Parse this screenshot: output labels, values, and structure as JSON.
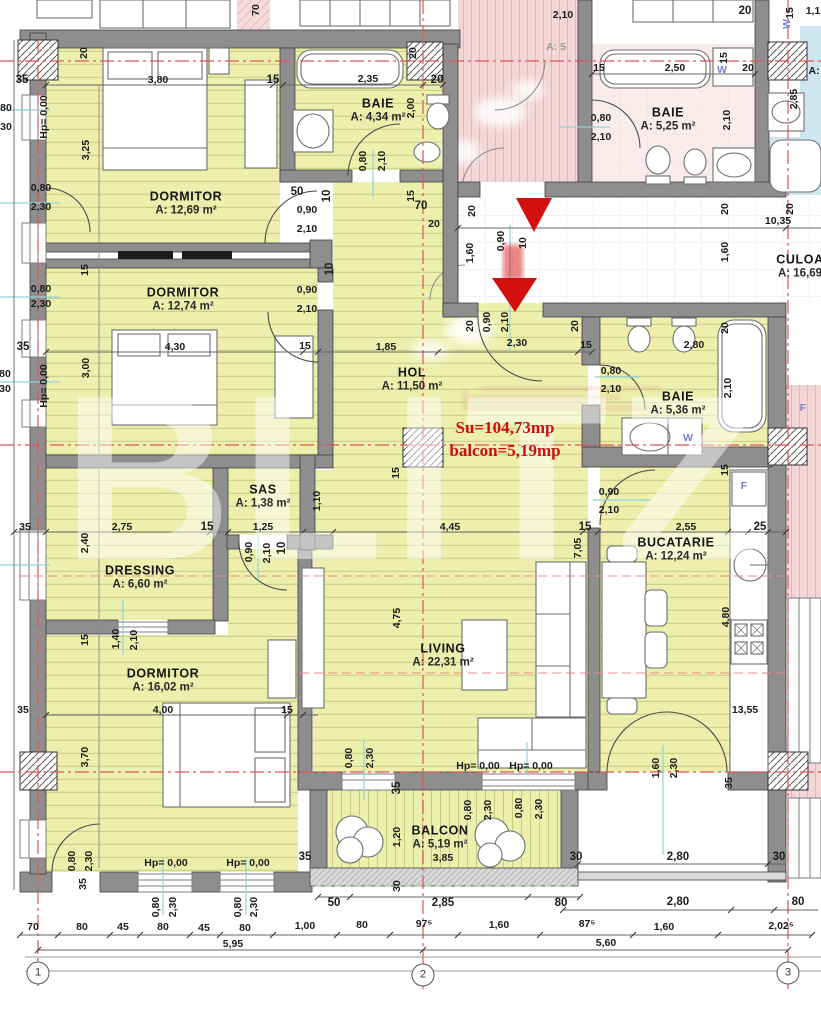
{
  "watermark": "BLITZ",
  "annotation": {
    "su": "Su=104,73mp",
    "balcon": "balcon=5,19mp"
  },
  "colors": {
    "floor_yellow": "#edf0ac",
    "hatch_yellow": "#c6cb85",
    "wall_gray": "#8e8e8e",
    "neighbor_pink": "#f6dcdb",
    "neighbor_blue": "#cfe6f0",
    "accent_red": "#cc0f0f",
    "axis_red": "#e05555",
    "marker_cyan": "#93d2dd",
    "dim_text": "#1c1c1c",
    "label_blue": "#7b7fd4"
  },
  "rooms": [
    {
      "id": "dormitor-1",
      "name": "DORMITOR",
      "area": "A: 12,69 m²",
      "x": 186,
      "y": 203
    },
    {
      "id": "baie-1",
      "name": "BAIE",
      "area": "A: 4,34 m²",
      "x": 378,
      "y": 110
    },
    {
      "id": "baie-vecin",
      "name": "BAIE",
      "area": "A: 5,25 m²",
      "x": 668,
      "y": 119
    },
    {
      "id": "dormitor-2",
      "name": "DORMITOR",
      "area": "A: 12,74 m²",
      "x": 183,
      "y": 299
    },
    {
      "id": "hol",
      "name": "HOL",
      "area": "A: 11,50 m²",
      "x": 412,
      "y": 379
    },
    {
      "id": "culoar",
      "name": "CULOA",
      "area": "A: 16,69",
      "x": 800,
      "y": 266
    },
    {
      "id": "baie-2",
      "name": "BAIE",
      "area": "A: 5,36 m²",
      "x": 678,
      "y": 403
    },
    {
      "id": "sas",
      "name": "SAS",
      "area": "A: 1,38 m²",
      "x": 263,
      "y": 496
    },
    {
      "id": "dressing",
      "name": "DRESSING",
      "area": "A: 6,60 m²",
      "x": 140,
      "y": 577
    },
    {
      "id": "living",
      "name": "LIVING",
      "area": "A: 22,31 m²",
      "x": 443,
      "y": 655
    },
    {
      "id": "bucatarie",
      "name": "BUCATARIE",
      "area": "A: 12,24 m²",
      "x": 676,
      "y": 549
    },
    {
      "id": "dormitor-3",
      "name": "DORMITOR",
      "area": "A: 16,02 m²",
      "x": 163,
      "y": 680
    },
    {
      "id": "balcon",
      "name": "BALCON",
      "area": "A: 5,19 m²",
      "x": 440,
      "y": 837
    }
  ],
  "dims": [
    {
      "t": "35",
      "x": 22,
      "y": 80,
      "b": 1
    },
    {
      "t": "20",
      "x": 84,
      "y": 53,
      "r": 1
    },
    {
      "t": "3,80",
      "x": 158,
      "y": 80
    },
    {
      "t": "15",
      "x": 273,
      "y": 80,
      "b": 1
    },
    {
      "t": "2,35",
      "x": 368,
      "y": 79
    },
    {
      "t": "20",
      "x": 413,
      "y": 53,
      "r": 1
    },
    {
      "t": "20",
      "x": 437,
      "y": 80,
      "b": 1
    },
    {
      "t": "70",
      "x": 256,
      "y": 10,
      "r": 1
    },
    {
      "t": "Hp= 0,00",
      "x": 44,
      "y": 117,
      "r": 1
    },
    {
      "t": "3,25",
      "x": 86,
      "y": 150,
      "r": 1
    },
    {
      "t": "0,80",
      "x": 41,
      "y": 188
    },
    {
      "t": "2,30",
      "x": 41,
      "y": 207
    },
    {
      "t": "2,00",
      "x": 411,
      "y": 108,
      "r": 1
    },
    {
      "t": "0,80",
      "x": 363,
      "y": 161,
      "r": 1
    },
    {
      "t": "2,10",
      "x": 382,
      "y": 161,
      "r": 1
    },
    {
      "t": "50",
      "x": 297,
      "y": 192,
      "b": 1
    },
    {
      "t": "10",
      "x": 327,
      "y": 196,
      "r": 1,
      "b": 1
    },
    {
      "t": "15",
      "x": 411,
      "y": 196,
      "r": 1
    },
    {
      "t": "0,90",
      "x": 307,
      "y": 210
    },
    {
      "t": "2,10",
      "x": 307,
      "y": 229
    },
    {
      "t": "80",
      "x": 6,
      "y": 108
    },
    {
      "t": "30",
      "x": 6,
      "y": 127
    },
    {
      "t": "80",
      "x": 5,
      "y": 374
    },
    {
      "t": "30",
      "x": 5,
      "y": 389
    },
    {
      "t": "2,10",
      "x": 563,
      "y": 15
    },
    {
      "t": "A: 5",
      "x": 556,
      "y": 47,
      "c": "gray"
    },
    {
      "t": "70",
      "x": 421,
      "y": 206,
      "b": 1
    },
    {
      "t": "20",
      "x": 434,
      "y": 224
    },
    {
      "t": "20",
      "x": 472,
      "y": 211,
      "r": 1
    },
    {
      "t": "1,60",
      "x": 470,
      "y": 253,
      "r": 1
    },
    {
      "t": "0,90",
      "x": 501,
      "y": 241,
      "r": 1
    },
    {
      "t": "10",
      "x": 523,
      "y": 243,
      "r": 1
    },
    {
      "t": "20",
      "x": 470,
      "y": 326,
      "r": 1
    },
    {
      "t": "0,90",
      "x": 487,
      "y": 322,
      "r": 1
    },
    {
      "t": "2,10",
      "x": 505,
      "y": 322,
      "r": 1
    },
    {
      "t": "20",
      "x": 575,
      "y": 326,
      "r": 1
    },
    {
      "t": "2,30",
      "x": 517,
      "y": 343
    },
    {
      "t": "15",
      "x": 586,
      "y": 345
    },
    {
      "t": "20",
      "x": 725,
      "y": 209,
      "r": 1
    },
    {
      "t": "20",
      "x": 790,
      "y": 209,
      "r": 1
    },
    {
      "t": "10,35",
      "x": 778,
      "y": 221
    },
    {
      "t": "1,60",
      "x": 725,
      "y": 252,
      "r": 1
    },
    {
      "t": "15",
      "x": 599,
      "y": 68
    },
    {
      "t": "2,50",
      "x": 675,
      "y": 68
    },
    {
      "t": "15",
      "x": 724,
      "y": 58,
      "r": 1
    },
    {
      "t": "W",
      "x": 722,
      "y": 70,
      "c": "blue"
    },
    {
      "t": "20",
      "x": 748,
      "y": 68
    },
    {
      "t": "0,80",
      "x": 601,
      "y": 118
    },
    {
      "t": "2,10",
      "x": 601,
      "y": 137
    },
    {
      "t": "2,10",
      "x": 727,
      "y": 120,
      "r": 1
    },
    {
      "t": "20",
      "x": 745,
      "y": 11,
      "b": 1
    },
    {
      "t": "15",
      "x": 790,
      "y": 13,
      "r": 1
    },
    {
      "t": "1,1",
      "x": 813,
      "y": 11
    },
    {
      "t": "W",
      "x": 787,
      "y": 24,
      "r": 1,
      "c": "blue"
    },
    {
      "t": "2,85",
      "x": 794,
      "y": 99,
      "r": 1
    },
    {
      "t": "A:",
      "x": 814,
      "y": 71
    },
    {
      "t": "15",
      "x": 85,
      "y": 270,
      "r": 1
    },
    {
      "t": "10",
      "x": 330,
      "y": 269,
      "r": 1,
      "b": 1
    },
    {
      "t": "0,80",
      "x": 41,
      "y": 289
    },
    {
      "t": "2,30",
      "x": 41,
      "y": 304
    },
    {
      "t": "0,90",
      "x": 307,
      "y": 290
    },
    {
      "t": "2,10",
      "x": 307,
      "y": 309
    },
    {
      "t": "35",
      "x": 23,
      "y": 347,
      "b": 1
    },
    {
      "t": "4,30",
      "x": 175,
      "y": 347
    },
    {
      "t": "15",
      "x": 305,
      "y": 346
    },
    {
      "t": "1,85",
      "x": 386,
      "y": 347
    },
    {
      "t": "3,00",
      "x": 86,
      "y": 368,
      "r": 1
    },
    {
      "t": "Hp= 0,00",
      "x": 44,
      "y": 386,
      "r": 1
    },
    {
      "t": "15",
      "x": 396,
      "y": 473,
      "r": 1
    },
    {
      "t": "0,80",
      "x": 611,
      "y": 371
    },
    {
      "t": "2,10",
      "x": 611,
      "y": 389
    },
    {
      "t": "2,80",
      "x": 694,
      "y": 345
    },
    {
      "t": "20",
      "x": 725,
      "y": 328,
      "r": 1
    },
    {
      "t": "2,10",
      "x": 728,
      "y": 388,
      "r": 1
    },
    {
      "t": "W",
      "x": 688,
      "y": 438,
      "c": "blue"
    },
    {
      "t": "15",
      "x": 725,
      "y": 470,
      "r": 1
    },
    {
      "t": "1,10",
      "x": 317,
      "y": 501,
      "r": 1
    },
    {
      "t": "35",
      "x": 25,
      "y": 527
    },
    {
      "t": "2,75",
      "x": 122,
      "y": 527
    },
    {
      "t": "15",
      "x": 207,
      "y": 527,
      "b": 1
    },
    {
      "t": "1,25",
      "x": 263,
      "y": 527
    },
    {
      "t": "2,40",
      "x": 85,
      "y": 543,
      "r": 1
    },
    {
      "t": "0,90",
      "x": 249,
      "y": 552,
      "r": 1
    },
    {
      "t": "2,10",
      "x": 267,
      "y": 553,
      "r": 1
    },
    {
      "t": "10",
      "x": 282,
      "y": 548,
      "r": 1,
      "b": 1
    },
    {
      "t": "15",
      "x": 85,
      "y": 640,
      "r": 1
    },
    {
      "t": "1,40",
      "x": 116,
      "y": 639,
      "r": 1
    },
    {
      "t": "2,10",
      "x": 134,
      "y": 640,
      "r": 1
    },
    {
      "t": "4,45",
      "x": 450,
      "y": 527
    },
    {
      "t": "15",
      "x": 585,
      "y": 527,
      "b": 1
    },
    {
      "t": "7,05",
      "x": 578,
      "y": 548,
      "r": 1
    },
    {
      "t": "4,75",
      "x": 397,
      "y": 618,
      "r": 1
    },
    {
      "t": "0,90",
      "x": 609,
      "y": 492
    },
    {
      "t": "2,10",
      "x": 609,
      "y": 510
    },
    {
      "t": "2,55",
      "x": 686,
      "y": 527
    },
    {
      "t": "25",
      "x": 760,
      "y": 527,
      "b": 1
    },
    {
      "t": "4,80",
      "x": 726,
      "y": 617,
      "r": 1
    },
    {
      "t": "13,55",
      "x": 745,
      "y": 710
    },
    {
      "t": "F",
      "x": 744,
      "y": 486,
      "c": "blue"
    },
    {
      "t": "F",
      "x": 803,
      "y": 408,
      "c": "blue"
    },
    {
      "t": "35",
      "x": 23,
      "y": 710
    },
    {
      "t": "4,00",
      "x": 163,
      "y": 710
    },
    {
      "t": "15",
      "x": 287,
      "y": 710
    },
    {
      "t": "3,70",
      "x": 85,
      "y": 757,
      "r": 1
    },
    {
      "t": "0,80",
      "x": 72,
      "y": 861,
      "r": 1
    },
    {
      "t": "2,30",
      "x": 89,
      "y": 861,
      "r": 1
    },
    {
      "t": "35",
      "x": 83,
      "y": 884,
      "r": 1
    },
    {
      "t": "Hp= 0,00",
      "x": 166,
      "y": 863
    },
    {
      "t": "Hp= 0,00",
      "x": 248,
      "y": 863
    },
    {
      "t": "0,80",
      "x": 156,
      "y": 907,
      "r": 1
    },
    {
      "t": "2,30",
      "x": 173,
      "y": 907,
      "r": 1
    },
    {
      "t": "0,80",
      "x": 238,
      "y": 907,
      "r": 1
    },
    {
      "t": "2,30",
      "x": 254,
      "y": 907,
      "r": 1
    },
    {
      "t": "35",
      "x": 305,
      "y": 857,
      "b": 1
    },
    {
      "t": "Hp= 0,00",
      "x": 478,
      "y": 766
    },
    {
      "t": "Hp= 0,00",
      "x": 531,
      "y": 766
    },
    {
      "t": "0,80",
      "x": 349,
      "y": 758,
      "r": 1
    },
    {
      "t": "2,30",
      "x": 370,
      "y": 758,
      "r": 1
    },
    {
      "t": "35",
      "x": 397,
      "y": 788,
      "r": 1,
      "b": 1
    },
    {
      "t": "0,80",
      "x": 468,
      "y": 810,
      "r": 1
    },
    {
      "t": "2,30",
      "x": 488,
      "y": 810,
      "r": 1
    },
    {
      "t": "0,80",
      "x": 519,
      "y": 808,
      "r": 1
    },
    {
      "t": "2,30",
      "x": 539,
      "y": 809,
      "r": 1
    },
    {
      "t": "1,20",
      "x": 397,
      "y": 837,
      "r": 1
    },
    {
      "t": "3,85",
      "x": 443,
      "y": 858
    },
    {
      "t": "30",
      "x": 397,
      "y": 886,
      "r": 1
    },
    {
      "t": "30",
      "x": 576,
      "y": 857,
      "b": 1
    },
    {
      "t": "1,60",
      "x": 656,
      "y": 768,
      "r": 1
    },
    {
      "t": "2,30",
      "x": 674,
      "y": 768,
      "r": 1
    },
    {
      "t": "35",
      "x": 729,
      "y": 783,
      "r": 1
    },
    {
      "t": "2,80",
      "x": 678,
      "y": 857,
      "b": 1
    },
    {
      "t": "30",
      "x": 779,
      "y": 857,
      "b": 1
    },
    {
      "t": "50",
      "x": 334,
      "y": 903,
      "b": 1
    },
    {
      "t": "2,85",
      "x": 443,
      "y": 903,
      "b": 1
    },
    {
      "t": "80",
      "x": 561,
      "y": 903,
      "b": 1
    },
    {
      "t": "2,80",
      "x": 678,
      "y": 902,
      "b": 1
    },
    {
      "t": "80",
      "x": 798,
      "y": 902,
      "b": 1
    },
    {
      "t": "70",
      "x": 33,
      "y": 927
    },
    {
      "t": "80",
      "x": 82,
      "y": 927
    },
    {
      "t": "45",
      "x": 123,
      "y": 927
    },
    {
      "t": "80",
      "x": 163,
      "y": 927
    },
    {
      "t": "45",
      "x": 204,
      "y": 928
    },
    {
      "t": "80",
      "x": 245,
      "y": 928
    },
    {
      "t": "1,00",
      "x": 305,
      "y": 926
    },
    {
      "t": "80",
      "x": 362,
      "y": 925
    },
    {
      "t": "97⁵",
      "x": 424,
      "y": 924
    },
    {
      "t": "1,60",
      "x": 499,
      "y": 925
    },
    {
      "t": "87⁵",
      "x": 587,
      "y": 924
    },
    {
      "t": "1,60",
      "x": 664,
      "y": 927
    },
    {
      "t": "2,02⁵",
      "x": 781,
      "y": 926
    },
    {
      "t": "5,95",
      "x": 233,
      "y": 944
    },
    {
      "t": "5,60",
      "x": 606,
      "y": 943
    }
  ],
  "grid_bubbles": [
    {
      "n": "1",
      "x": 38,
      "y": 973
    },
    {
      "n": "2",
      "x": 423,
      "y": 975
    },
    {
      "n": "3",
      "x": 788,
      "y": 973
    }
  ]
}
